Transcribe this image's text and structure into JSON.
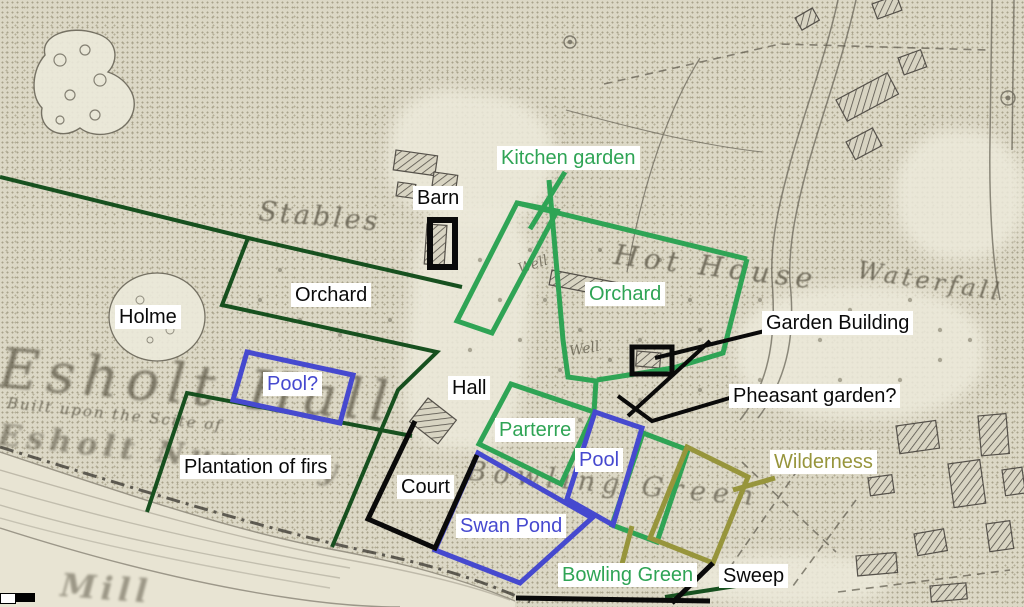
{
  "colors": {
    "bright_green": "#2fa455",
    "dark_green": "#17501f",
    "blue": "#4649cf",
    "olive": "#97953c",
    "black": "#0a0a0a",
    "label_bg": "#ffffff",
    "paper": "#dcd8c6",
    "map_ink": "#6b675a"
  },
  "annotations": {
    "labels": [
      {
        "id": "kitchen-garden",
        "text": "Kitchen garden",
        "color": "bright_green"
      },
      {
        "id": "barn",
        "text": "Barn",
        "color": "black"
      },
      {
        "id": "orchard-west",
        "text": "Orchard",
        "color": "black"
      },
      {
        "id": "orchard-east",
        "text": "Orchard",
        "color": "bright_green"
      },
      {
        "id": "holme",
        "text": "Holme",
        "color": "black"
      },
      {
        "id": "garden-building",
        "text": "Garden Building",
        "color": "black"
      },
      {
        "id": "pheasant-garden",
        "text": "Pheasant garden?",
        "color": "black"
      },
      {
        "id": "pool-question",
        "text": "Pool?",
        "color": "blue"
      },
      {
        "id": "hall",
        "text": "Hall",
        "color": "black"
      },
      {
        "id": "parterre",
        "text": "Parterre",
        "color": "bright_green"
      },
      {
        "id": "pool",
        "text": "Pool",
        "color": "blue"
      },
      {
        "id": "court",
        "text": "Court",
        "color": "black"
      },
      {
        "id": "swan-pond",
        "text": "Swan Pond",
        "color": "blue"
      },
      {
        "id": "plantation",
        "text": "Plantation of firs",
        "color": "black"
      },
      {
        "id": "bowling-green",
        "text": "Bowling Green",
        "color": "bright_green"
      },
      {
        "id": "sweep",
        "text": "Sweep",
        "color": "black"
      },
      {
        "id": "wilderness",
        "text": "Wilderness",
        "color": "olive"
      }
    ]
  },
  "map_layer": {
    "texts": {
      "stables": "Stables",
      "esholt_hall": "Esholt Hall",
      "built_upon": "Built upon the Scite of",
      "nunnery": "Esholt Nunnery",
      "mill": "Mill",
      "hot_house": "Hot House",
      "waterfall": "Waterfall",
      "bowling_green": "Bowling Green",
      "well_1": "Well",
      "well_2": "Well"
    }
  }
}
